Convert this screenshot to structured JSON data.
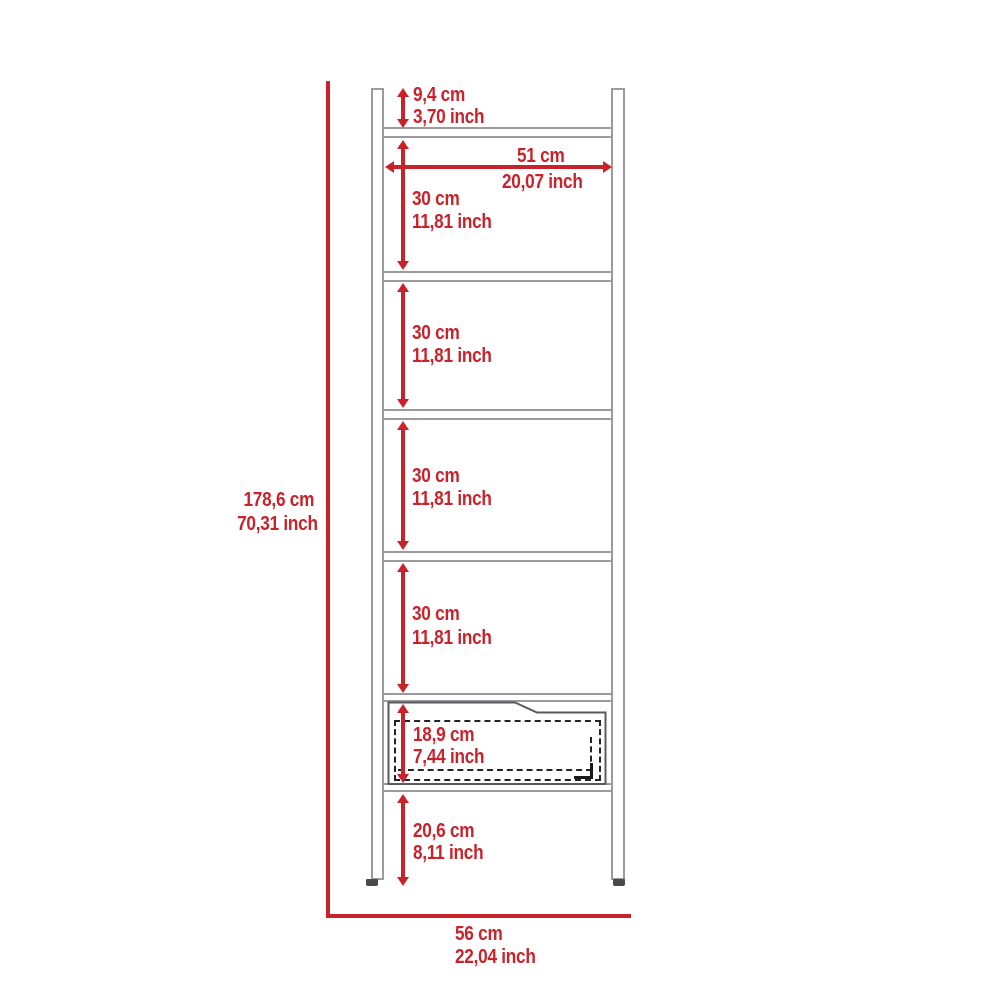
{
  "diagram": {
    "title": "Ladder shelf with drawer - dimension drawing",
    "colors": {
      "dimension_red": "#c8232b",
      "furniture_gray": "#9b9b9d",
      "drawer_outline": "#595a5e",
      "dashed_outline": "#232323",
      "background": "#ffffff"
    },
    "labels": {
      "top_offset": {
        "cm": "9,4 cm",
        "inch": "3,70 inch"
      },
      "shelf_width": {
        "cm": "51 cm",
        "inch": "20,07 inch"
      },
      "shelf_gaps": [
        {
          "cm": "30 cm",
          "inch": "11,81 inch"
        },
        {
          "cm": "30 cm",
          "inch": "11,81 inch"
        },
        {
          "cm": "30 cm",
          "inch": "11,81 inch"
        },
        {
          "cm": "30 cm",
          "inch": "11,81 inch"
        }
      ],
      "total_height": {
        "cm": "178,6 cm",
        "inch": "70,31 inch"
      },
      "drawer_height": {
        "cm": "18,9 cm",
        "inch": "7,44 inch"
      },
      "leg_height": {
        "cm": "20,6 cm",
        "inch": "8,11 inch"
      },
      "total_width": {
        "cm": "56 cm",
        "inch": "22,04 inch"
      }
    }
  }
}
